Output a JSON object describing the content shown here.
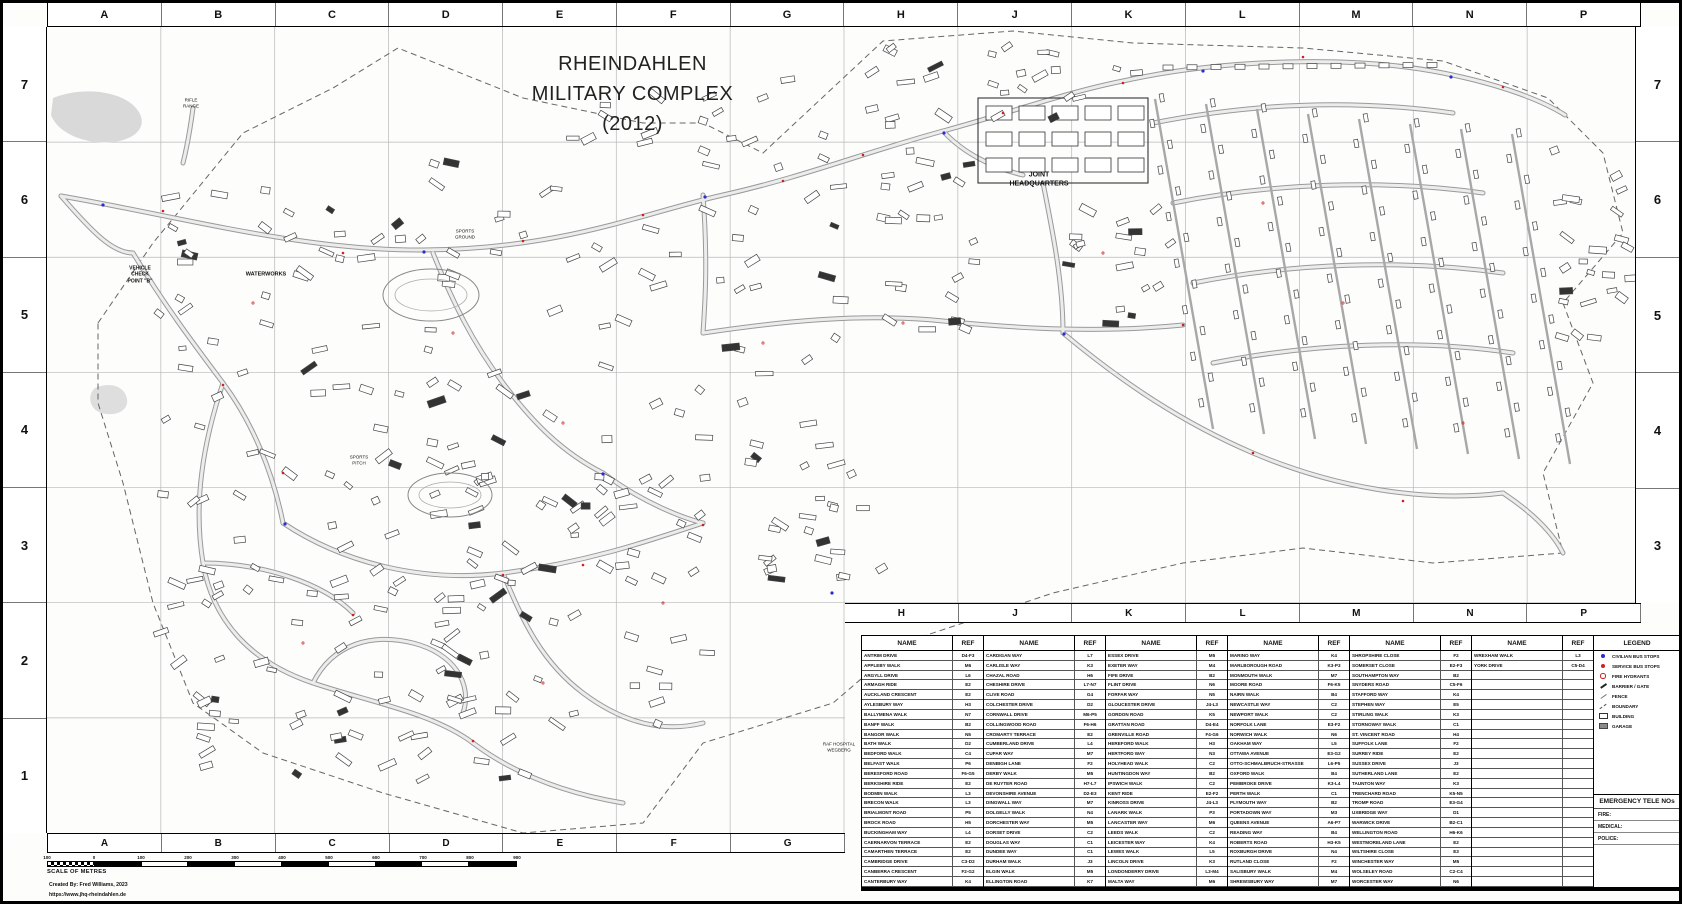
{
  "title": {
    "line1": "RHEINDAHLEN",
    "line2": "MILITARY COMPLEX",
    "line3": "(2012)"
  },
  "grid": {
    "column_letters": [
      "A",
      "B",
      "C",
      "D",
      "E",
      "F",
      "G",
      "H",
      "J",
      "K",
      "L",
      "M",
      "N",
      "P"
    ],
    "row_numbers": [
      "7",
      "6",
      "5",
      "4",
      "3",
      "2",
      "1"
    ]
  },
  "map_labels": [
    {
      "text": "JOINT\nHEADQUARTERS",
      "x": 1036,
      "y": 177,
      "fs": 7,
      "bold": true
    },
    {
      "text": "WATERWORKS",
      "x": 263,
      "y": 272,
      "fs": 5.5,
      "bold": true
    },
    {
      "text": "VEHICLE\nCHECK\nPOINT \"B\"",
      "x": 137,
      "y": 272,
      "fs": 5,
      "bold": true
    },
    {
      "text": "RAF HOSPITAL\nWEGBERG",
      "x": 836,
      "y": 744,
      "fs": 4.5,
      "bold": false
    },
    {
      "text": "RIFLE\nRANGE",
      "x": 188,
      "y": 100,
      "fs": 4.5,
      "bold": false
    },
    {
      "text": "SPORTS\nGROUND",
      "x": 462,
      "y": 231,
      "fs": 4.5,
      "bold": false
    },
    {
      "text": "SPORTS\nPITCH",
      "x": 356,
      "y": 457,
      "fs": 4.5,
      "bold": false
    }
  ],
  "street_index": {
    "name_header": "NAME",
    "ref_header": "REF",
    "columns": [
      {
        "rows": [
          {
            "name": "ANTRIM DRIVE",
            "ref": "D4-F3"
          },
          {
            "name": "APPLEBY WALK",
            "ref": "M6"
          },
          {
            "name": "ARGYLL DRIVE",
            "ref": "L6"
          },
          {
            "name": "ARMAGH RIDE",
            "ref": "E2"
          },
          {
            "name": "AUCKLAND CRESCENT",
            "ref": "E2"
          },
          {
            "name": "AYLESBURY WAY",
            "ref": "H3"
          },
          {
            "name": "BALLYMENA WALK",
            "ref": "N7"
          },
          {
            "name": "BANFF WALK",
            "ref": "B2"
          },
          {
            "name": "BANGOR WALK",
            "ref": "N5"
          },
          {
            "name": "BATH WALK",
            "ref": "D2"
          },
          {
            "name": "BEDFORD WALK",
            "ref": "C4"
          },
          {
            "name": "BELFAST WALK",
            "ref": "P6"
          },
          {
            "name": "BERESFORD ROAD",
            "ref": "F6-G5"
          },
          {
            "name": "BERKSHIRE RIDE",
            "ref": "E2"
          },
          {
            "name": "BODMIN WALK",
            "ref": "L3"
          },
          {
            "name": "BRECON WALK",
            "ref": "L3"
          },
          {
            "name": "BRIALMONT ROAD",
            "ref": "P5"
          },
          {
            "name": "BROCK ROAD",
            "ref": "H5"
          },
          {
            "name": "BUCKINGHAM WAY",
            "ref": "L4"
          },
          {
            "name": "CAERNARVON TERRACE",
            "ref": "E2"
          },
          {
            "name": "CAMARTHEN TERRACE",
            "ref": "E2"
          },
          {
            "name": "CAMBRIDGE DRIVE",
            "ref": "C3-D2"
          },
          {
            "name": "CANBERRA CRESCENT",
            "ref": "F2-G2"
          },
          {
            "name": "CANTERBURY WAY",
            "ref": "K4"
          }
        ]
      },
      {
        "rows": [
          {
            "name": "CARDIGAN WAY",
            "ref": "L7"
          },
          {
            "name": "CARLISLE WAY",
            "ref": "K3"
          },
          {
            "name": "CHAZAL ROAD",
            "ref": "H6"
          },
          {
            "name": "CHESHIRE DRIVE",
            "ref": "L7-N7"
          },
          {
            "name": "CLIVE ROAD",
            "ref": "G4"
          },
          {
            "name": "COLCHESTER DRIVE",
            "ref": "D2"
          },
          {
            "name": "CORNWALL DRIVE",
            "ref": "M6-P5"
          },
          {
            "name": "COLLINGWOOD ROAD",
            "ref": "F6-H6"
          },
          {
            "name": "CROMARTY TERRACE",
            "ref": "E2"
          },
          {
            "name": "CUMBERLAND DRIVE",
            "ref": "L4"
          },
          {
            "name": "CUPAR WAY",
            "ref": "M7"
          },
          {
            "name": "DENBIGH LANE",
            "ref": "F2"
          },
          {
            "name": "DERBY WALK",
            "ref": "M5"
          },
          {
            "name": "DE RUYTER ROAD",
            "ref": "H7-L7"
          },
          {
            "name": "DEVONSHIRE AVENUE",
            "ref": "D2-E3"
          },
          {
            "name": "DINGWALL WAY",
            "ref": "M7"
          },
          {
            "name": "DOLGELLY WALK",
            "ref": "N4"
          },
          {
            "name": "DORCHESTER WAY",
            "ref": "M5"
          },
          {
            "name": "DORSET DRIVE",
            "ref": "C2"
          },
          {
            "name": "DOUGLAS WAY",
            "ref": "C1"
          },
          {
            "name": "DUNDEE WAY",
            "ref": "C1"
          },
          {
            "name": "DURHAM WALK",
            "ref": "J3"
          },
          {
            "name": "ELGIN WALK",
            "ref": "M5"
          },
          {
            "name": "ELLINGTON ROAD",
            "ref": "K7"
          }
        ]
      },
      {
        "rows": [
          {
            "name": "ESSEX DRIVE",
            "ref": "M5"
          },
          {
            "name": "EXETER WAY",
            "ref": "M4"
          },
          {
            "name": "FIFE DRIVE",
            "ref": "B2"
          },
          {
            "name": "FLINT DRIVE",
            "ref": "N6"
          },
          {
            "name": "FORFAR WAY",
            "ref": "N5"
          },
          {
            "name": "GLOUCESTER DRIVE",
            "ref": "J4-L3"
          },
          {
            "name": "GORDON ROAD",
            "ref": "K5"
          },
          {
            "name": "GRATTAN ROAD",
            "ref": "D4-E4"
          },
          {
            "name": "GRENVILLE ROAD",
            "ref": "F4-G6"
          },
          {
            "name": "HEREFORD WALK",
            "ref": "H3"
          },
          {
            "name": "HERTFORD WAY",
            "ref": "N3"
          },
          {
            "name": "HOLYHEAD WALK",
            "ref": "C2"
          },
          {
            "name": "HUNTINGDON WAY",
            "ref": "B2"
          },
          {
            "name": "IPSWICH WALK",
            "ref": "C2"
          },
          {
            "name": "KENT RIDE",
            "ref": "E2-F2"
          },
          {
            "name": "KINROSS DRIVE",
            "ref": "J4-L3"
          },
          {
            "name": "LANARK WALK",
            "ref": "P3"
          },
          {
            "name": "LANCASTER WAY",
            "ref": "M6"
          },
          {
            "name": "LEEDS WALK",
            "ref": "C2"
          },
          {
            "name": "LEICESTER WAY",
            "ref": "K4"
          },
          {
            "name": "LEWES WALK",
            "ref": "L5"
          },
          {
            "name": "LINCOLN DRIVE",
            "ref": "K3"
          },
          {
            "name": "LONDONDERRY DRIVE",
            "ref": "L3-M4"
          },
          {
            "name": "MALTA WAY",
            "ref": "M6"
          }
        ]
      },
      {
        "rows": [
          {
            "name": "MARINO WAY",
            "ref": "K4"
          },
          {
            "name": "MARLBOROUGH ROAD",
            "ref": "K3-P3"
          },
          {
            "name": "MONMOUTH WALK",
            "ref": "M7"
          },
          {
            "name": "MOORE ROAD",
            "ref": "F6-K5"
          },
          {
            "name": "NAIRN WALK",
            "ref": "B4"
          },
          {
            "name": "NEWCASTLE WAY",
            "ref": "C2"
          },
          {
            "name": "NEWPORT WALK",
            "ref": "C2"
          },
          {
            "name": "NORFOLK LANE",
            "ref": "E3-F2"
          },
          {
            "name": "NORWICH WALK",
            "ref": "N6"
          },
          {
            "name": "OAKHAM WAY",
            "ref": "L5"
          },
          {
            "name": "OTTAWA AVENUE",
            "ref": "E3-G2"
          },
          {
            "name": "OTTO-SCHMALBRUCH-STRASSE",
            "ref": "L6-P5"
          },
          {
            "name": "OXFORD WALK",
            "ref": "B4"
          },
          {
            "name": "PEMBROKE DRIVE",
            "ref": "K3-L4"
          },
          {
            "name": "PERTH WALK",
            "ref": "C1"
          },
          {
            "name": "PLYMOUTH WAY",
            "ref": "B2"
          },
          {
            "name": "PORTADOWN WAY",
            "ref": "M3"
          },
          {
            "name": "QUEENS AVENUE",
            "ref": "A6-P7"
          },
          {
            "name": "READING WAY",
            "ref": "B4"
          },
          {
            "name": "ROBERTS ROAD",
            "ref": "H3-K5"
          },
          {
            "name": "ROXBURGH DRIVE",
            "ref": "N4"
          },
          {
            "name": "RUTLAND CLOSE",
            "ref": "F2"
          },
          {
            "name": "SALISBURY WALK",
            "ref": "M4"
          },
          {
            "name": "SHREWSBURY WAY",
            "ref": "M7"
          }
        ]
      },
      {
        "rows": [
          {
            "name": "SHROPSHIRE CLOSE",
            "ref": "F2"
          },
          {
            "name": "SOMERSET CLOSE",
            "ref": "E2-F3"
          },
          {
            "name": "SOUTHAMPTON WAY",
            "ref": "B2"
          },
          {
            "name": "SNYDERS ROAD",
            "ref": "C5-F6"
          },
          {
            "name": "STAFFORD WAY",
            "ref": "K4"
          },
          {
            "name": "STEPHEN WAY",
            "ref": "E5"
          },
          {
            "name": "STIRLING WALK",
            "ref": "K3"
          },
          {
            "name": "STORNOWAY WALK",
            "ref": "C1"
          },
          {
            "name": "ST. VINCENT ROAD",
            "ref": "H4"
          },
          {
            "name": "SUFFOLK LANE",
            "ref": "F2"
          },
          {
            "name": "SURREY RIDE",
            "ref": "E2"
          },
          {
            "name": "SUSSEX DRIVE",
            "ref": "J3"
          },
          {
            "name": "SUTHERLAND LANE",
            "ref": "E2"
          },
          {
            "name": "TAUNTON WAY",
            "ref": "K3"
          },
          {
            "name": "TRENCHARD ROAD",
            "ref": "K5-N5"
          },
          {
            "name": "TROMP ROAD",
            "ref": "E3-G4"
          },
          {
            "name": "UXBRIDGE WAY",
            "ref": "D1"
          },
          {
            "name": "WARWICK DRIVE",
            "ref": "B2-C1"
          },
          {
            "name": "WELLINGTON ROAD",
            "ref": "H6-K6"
          },
          {
            "name": "WESTMORELAND LANE",
            "ref": "E2"
          },
          {
            "name": "WILTSHIRE CLOSE",
            "ref": "E3"
          },
          {
            "name": "WINCHESTER WAY",
            "ref": "M5"
          },
          {
            "name": "WOLSELEY ROAD",
            "ref": "C2-C4"
          },
          {
            "name": "WORCESTER WAY",
            "ref": "N6"
          }
        ]
      },
      {
        "rows": [
          {
            "name": "WREXHAM WALK",
            "ref": "L3"
          },
          {
            "name": "YORK DRIVE",
            "ref": "C5-D4"
          }
        ]
      }
    ]
  },
  "legend": {
    "header": "LEGEND",
    "items": [
      {
        "symbol": "dot-blue",
        "label": "CIVILIAN BUS STOPS",
        "color": "#2b2bd0"
      },
      {
        "symbol": "dot-red",
        "label": "SERVICE BUS STOPS",
        "color": "#cc2222"
      },
      {
        "symbol": "circle-red",
        "label": "FIRE HYDRANTS",
        "color": "#cc2222"
      },
      {
        "symbol": "slash-bold",
        "label": "BARRIER / GATE",
        "color": "#222222"
      },
      {
        "symbol": "slash-thin",
        "label": "FENCE",
        "color": "#777777"
      },
      {
        "symbol": "slash-dashed",
        "label": "BOUNDARY",
        "color": "#555555"
      },
      {
        "symbol": "building",
        "label": "BUILDING",
        "color": "#333333"
      },
      {
        "symbol": "garage",
        "label": "GARAGE",
        "color": "#8a8a8a"
      }
    ]
  },
  "emergency": {
    "header": "EMERGENCY TELE NOs",
    "rows": [
      "FIRE:",
      "MEDICAL:",
      "POLICE:"
    ]
  },
  "scale": {
    "title": "SCALE OF METRES",
    "tick_labels": [
      "100",
      "0",
      "100",
      "200",
      "300",
      "400",
      "500",
      "600",
      "700",
      "800",
      "900"
    ]
  },
  "credits": {
    "line1": "Created By: Fred Williams, 2023",
    "line2": "https://www.jhq-rheindahlen.de"
  }
}
